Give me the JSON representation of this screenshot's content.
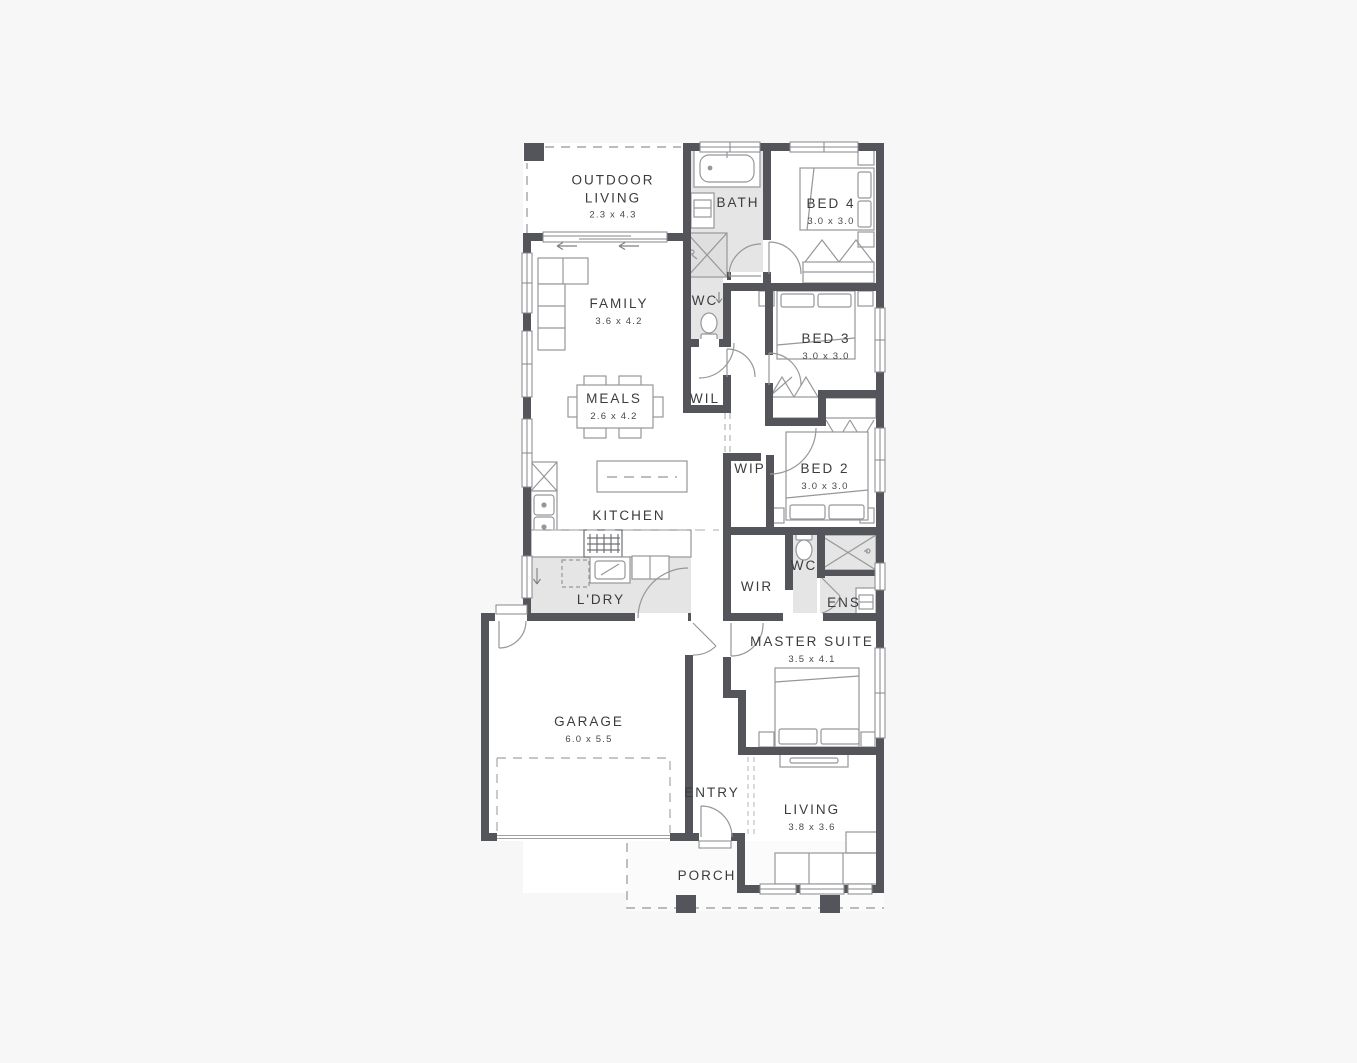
{
  "colors": {
    "background": "#f7f7f7",
    "wall": "#53555a",
    "floor": "#ffffff",
    "floor_shaded": "#e5e5e6",
    "furniture_line": "#96979a",
    "text": "#3b3c3f"
  },
  "icons": {
    "down_arrow": "↓",
    "slide_arrow": "←"
  },
  "rooms": [
    {
      "id": "outdoor-living",
      "name": "OUTDOOR LIVING",
      "dims": "2.3 x 4.3"
    },
    {
      "id": "bath",
      "name": "BATH",
      "dims": ""
    },
    {
      "id": "bed4",
      "name": "BED 4",
      "dims": "3.0 x 3.0"
    },
    {
      "id": "family",
      "name": "FAMILY",
      "dims": "3.6 x 4.2"
    },
    {
      "id": "wc-1",
      "name": "WC",
      "dims": ""
    },
    {
      "id": "bed3",
      "name": "BED 3",
      "dims": "3.0 x 3.0"
    },
    {
      "id": "meals",
      "name": "MEALS",
      "dims": "2.6 x 4.2"
    },
    {
      "id": "wil",
      "name": "WIL",
      "dims": ""
    },
    {
      "id": "wip",
      "name": "WIP",
      "dims": ""
    },
    {
      "id": "bed2",
      "name": "BED 2",
      "dims": "3.0 x 3.0"
    },
    {
      "id": "kitchen",
      "name": "KITCHEN",
      "dims": ""
    },
    {
      "id": "laundry",
      "name": "L'DRY",
      "dims": ""
    },
    {
      "id": "wir",
      "name": "WIR",
      "dims": ""
    },
    {
      "id": "wc-2",
      "name": "WC",
      "dims": ""
    },
    {
      "id": "ens",
      "name": "ENS",
      "dims": ""
    },
    {
      "id": "master-suite",
      "name": "MASTER SUITE",
      "dims": "3.5 x 4.1"
    },
    {
      "id": "garage",
      "name": "GARAGE",
      "dims": "6.0 x 5.5"
    },
    {
      "id": "entry",
      "name": "ENTRY",
      "dims": ""
    },
    {
      "id": "living",
      "name": "LIVING",
      "dims": "3.8 x 3.6"
    },
    {
      "id": "porch",
      "name": "PORCH",
      "dims": ""
    }
  ]
}
